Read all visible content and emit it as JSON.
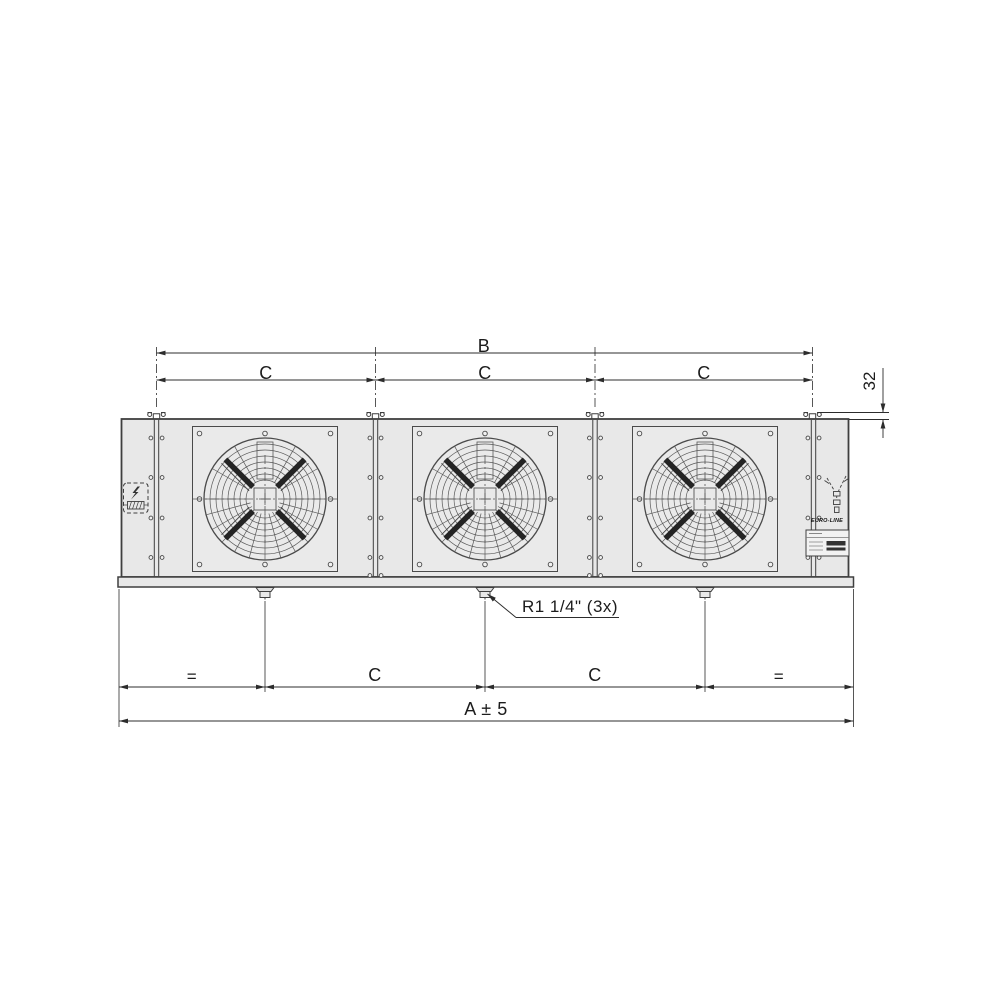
{
  "drawing_type": "unit-cooler-front-view",
  "fans": {
    "count": 3
  },
  "dimensions": {
    "overall_top": "B",
    "fan_pitch_top": [
      "C",
      "C",
      "C"
    ],
    "bracket_offset": "32",
    "equal_left": "=",
    "drain_pitch": [
      "C",
      "C"
    ],
    "equal_right": "=",
    "overall_bottom": "A ± 5"
  },
  "callouts": {
    "drain_connection": "R1 1/4\" (3x)"
  },
  "branding": {
    "logo": "EURO-LINE"
  },
  "colors": {
    "background": "#ffffff",
    "outline": "#3f3f3f",
    "dimension_lines": "#2c2c2c",
    "panel_fill": "#e8e8e8",
    "fan_blade": "#242424"
  },
  "icons": [
    "electrical-connection-icon",
    "refrigerant-connection-icon",
    "mounting-bracket",
    "drain-fitting"
  ]
}
